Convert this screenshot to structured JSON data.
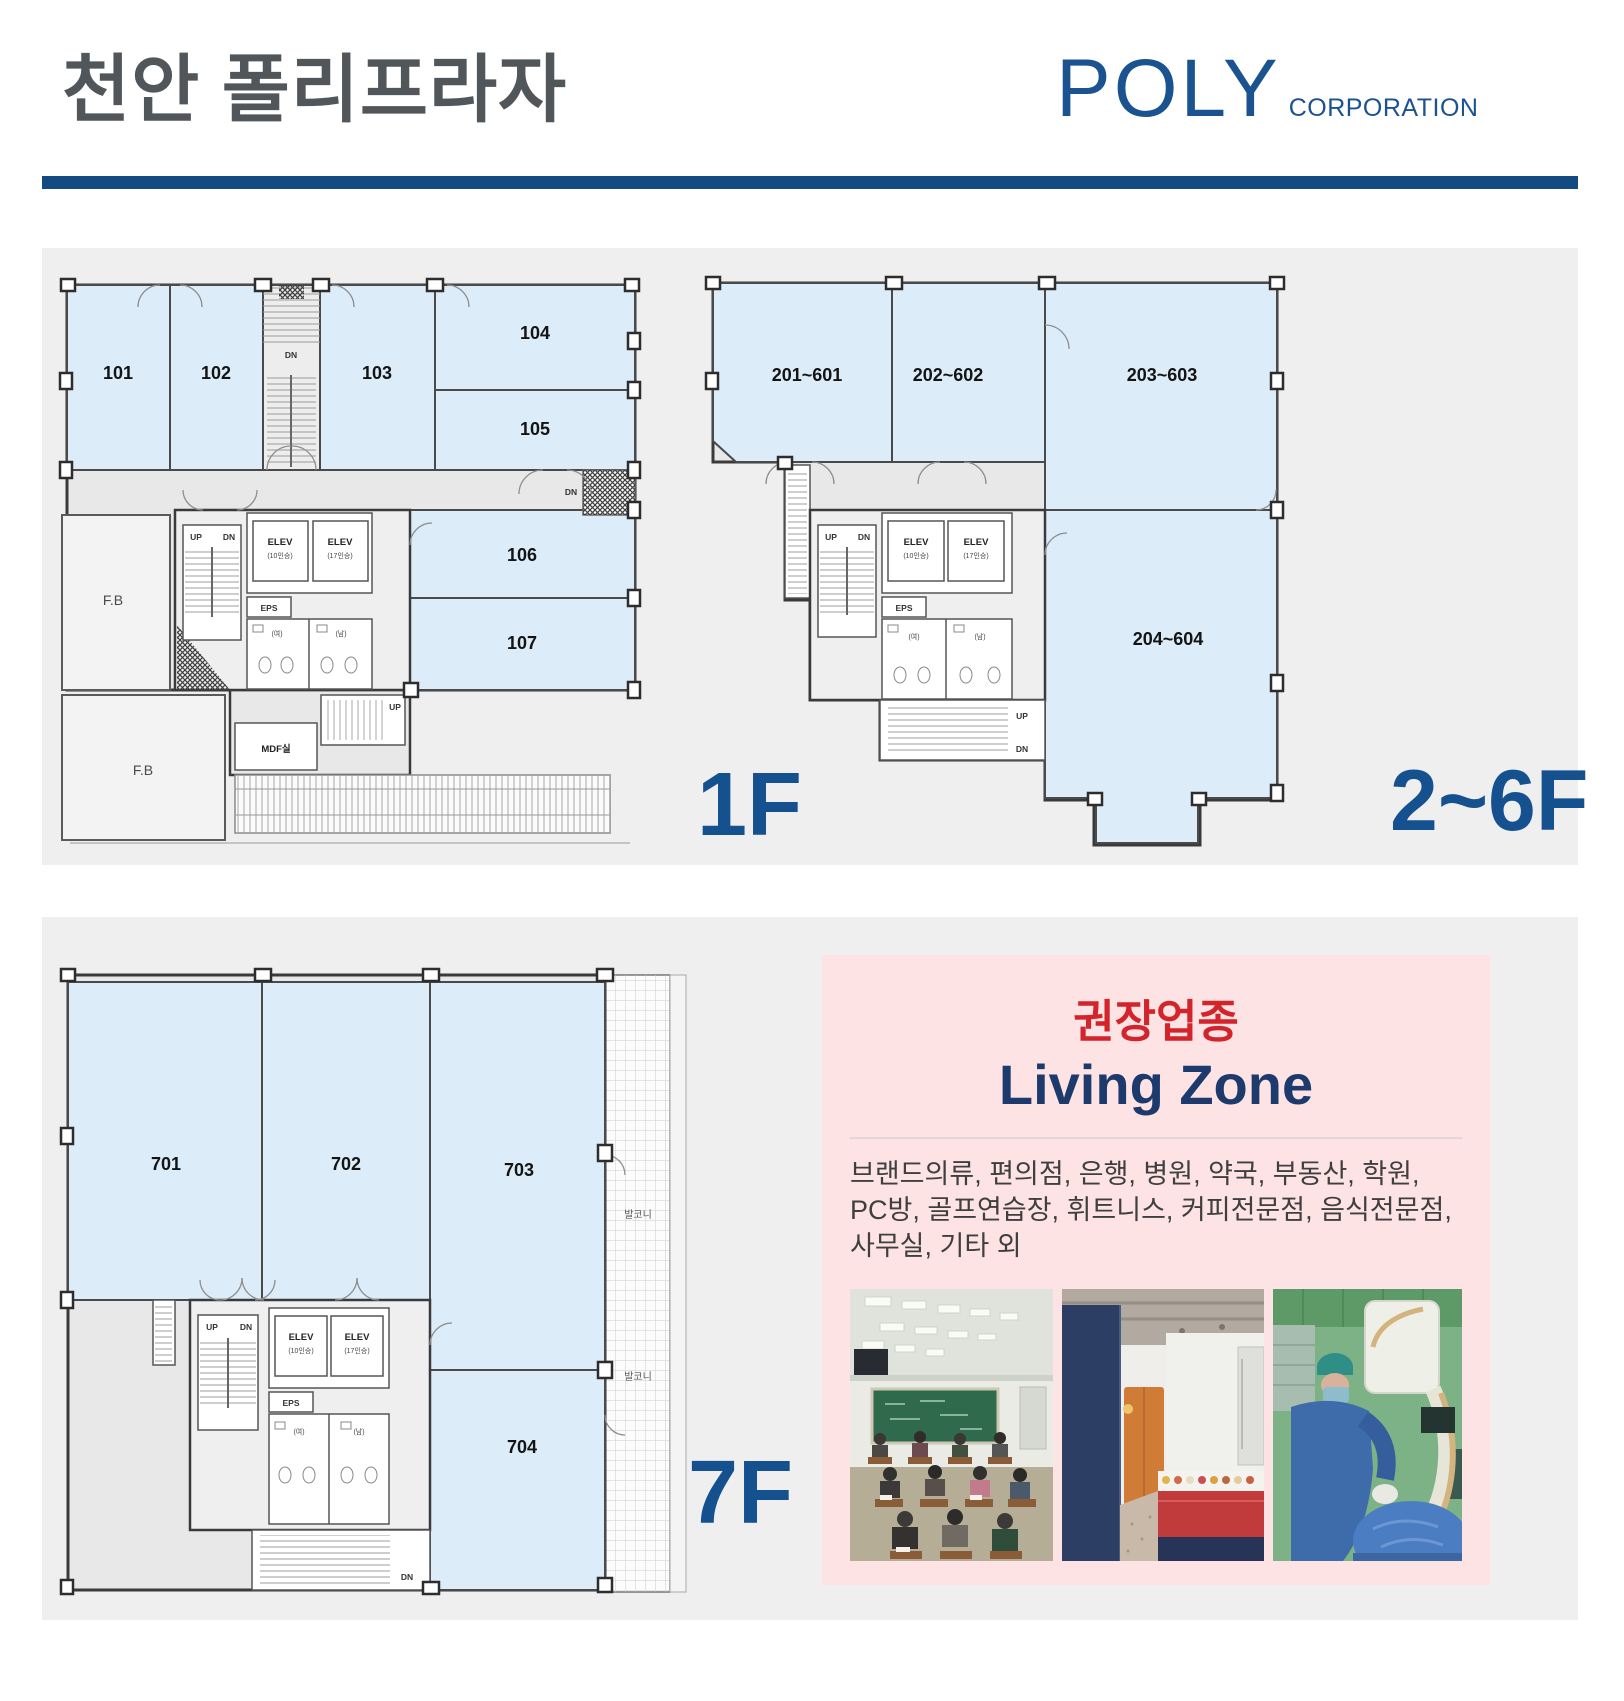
{
  "header": {
    "title": "천안 폴리프라자",
    "brand": "POLY",
    "brand_suffix": "CORPORATION"
  },
  "floors": {
    "f1": {
      "label": "1F",
      "rooms": [
        "101",
        "102",
        "103",
        "104",
        "105",
        "106",
        "107"
      ]
    },
    "f26": {
      "label": "2~6F",
      "rooms": [
        "201~601",
        "202~602",
        "203~603",
        "204~604"
      ]
    },
    "f7": {
      "label": "7F",
      "rooms": [
        "701",
        "702",
        "703",
        "704"
      ]
    }
  },
  "plan_labels": {
    "elev": "ELEV",
    "cap10": "(10인승)",
    "cap17": "(17인승)",
    "eps": "EPS",
    "up": "UP",
    "dn": "DN",
    "mdf": "MDF실",
    "fb": "F.B",
    "wc_w": "(여)",
    "wc_m": "(남)",
    "balcony": "발코니"
  },
  "recommend": {
    "title": "권장업종",
    "zone": "Living Zone",
    "lines": [
      "브랜드의류, 편의점, 은행, 병원, 약국, 부동산, 학원,",
      "PC방, 골프연습장, 휘트니스, 커피전문점, 음식전문점,",
      "사무실, 기타 외"
    ]
  },
  "colors": {
    "accent_blue": "#134a82",
    "floor_label_blue": "#15508f",
    "logo_blue": "#1b5290",
    "highlight_red": "#d3232b",
    "zone_navy": "#1d3a6d",
    "room_fill": "#dcedf9",
    "recommend_bg": "#fde3e3",
    "panel_bg": "#efefef"
  }
}
